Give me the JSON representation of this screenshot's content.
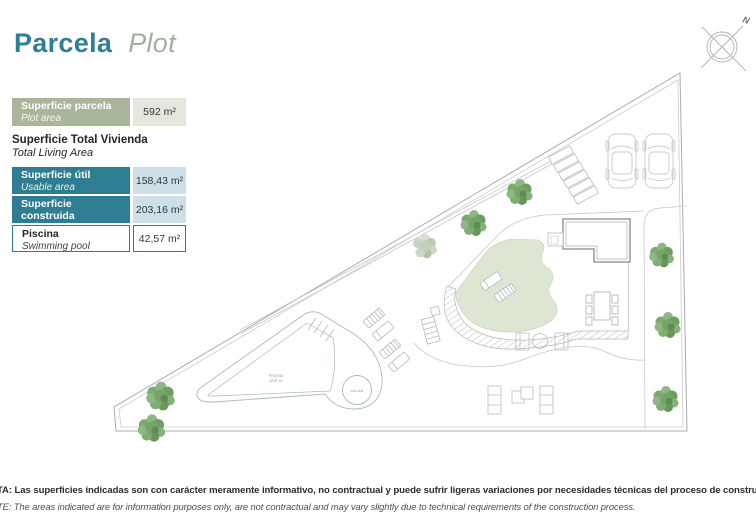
{
  "title": {
    "es": "Parcela",
    "en": "Plot"
  },
  "legend": {
    "parcel": {
      "label_es": "Superficie parcela",
      "label_en": "Plot area",
      "value": "592 m²"
    },
    "total_heading_es": "Superficie Total Vivienda",
    "total_heading_en": "Total Living Area",
    "rows": [
      {
        "label_es": "Superficie útil",
        "label_en": "Usable area",
        "value": "158,43 m²"
      },
      {
        "label_es": "Superficie construida",
        "label_en": "Built area",
        "value": "203,16 m²"
      },
      {
        "label_es": "Piscina",
        "label_en": "Swimming pool",
        "value": "42,57 m²"
      }
    ]
  },
  "plan": {
    "pool_label": "PISCINA",
    "pool_area": "42,57 m²",
    "jacuzzi_label": "JACUZZI",
    "compass_label": "N",
    "features": [
      "plot-boundary",
      "driveway",
      "steps",
      "two-cars",
      "house-footprint",
      "terrace-green",
      "curved-steps-band",
      "dining-table",
      "fire-pit",
      "sun-loungers",
      "barbecue",
      "pool",
      "jacuzzi",
      "sofa-set",
      "trees",
      "side-path"
    ]
  },
  "footer": {
    "line_es": "TA: Las superficies indicadas son con carácter meramente informativo, no contractual y puede sufrir ligeras variaciones por necesidades técnicas del proceso de construcción",
    "line_en": "TE: The areas indicated are for information purposes only, are not contractual and may vary slightly due to technical requirements of the construction process."
  },
  "colors": {
    "teal": "#2e7e93",
    "sage": "#a9b69b",
    "light_blue": "#cde0e8",
    "light_sage": "#e4e7dd",
    "title_teal": "#2f7f96",
    "title_green": "#a2b0a0",
    "terrace_green": "#dde6d2",
    "tree_green": "#76a56a"
  }
}
